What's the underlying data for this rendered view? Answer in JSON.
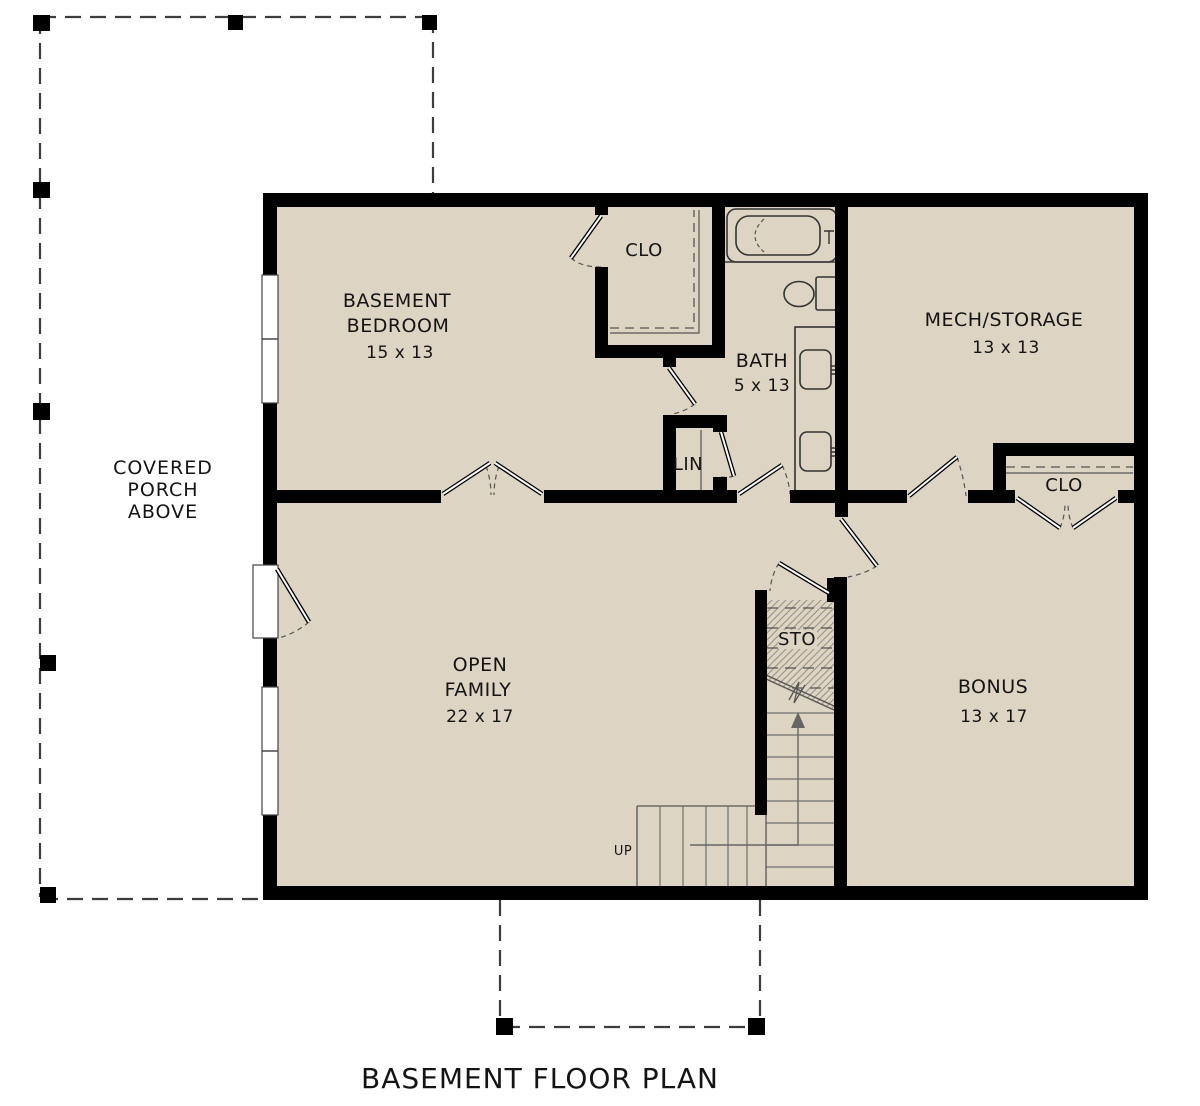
{
  "title": "BASEMENT FLOOR PLAN",
  "rooms": {
    "bedroom": {
      "name_line1": "BASEMENT",
      "name_line2": "BEDROOM",
      "dims": "15 x 13"
    },
    "bedroom_closet": {
      "name": "CLO"
    },
    "bath": {
      "name": "BATH",
      "dims": "5 x 13"
    },
    "mech_storage": {
      "name": "MECH/STORAGE",
      "dims": "13 x 13"
    },
    "linen": {
      "name": "LIN"
    },
    "bonus_closet": {
      "name": "CLO"
    },
    "open_family": {
      "name_line1": "OPEN",
      "name_line2": "FAMILY",
      "dims": "22 x 17"
    },
    "bonus": {
      "name": "BONUS",
      "dims": "13 x 17"
    },
    "under_stair_storage": {
      "name": "STO"
    }
  },
  "stairs": {
    "direction_label": "UP"
  },
  "porch": {
    "line1": "COVERED",
    "line2": "PORCH",
    "line3": "ABOVE"
  },
  "colors": {
    "floor": "#ddd4c3",
    "wall": "#000000",
    "background": "#ffffff",
    "thin_line": "#3c3c3c"
  }
}
